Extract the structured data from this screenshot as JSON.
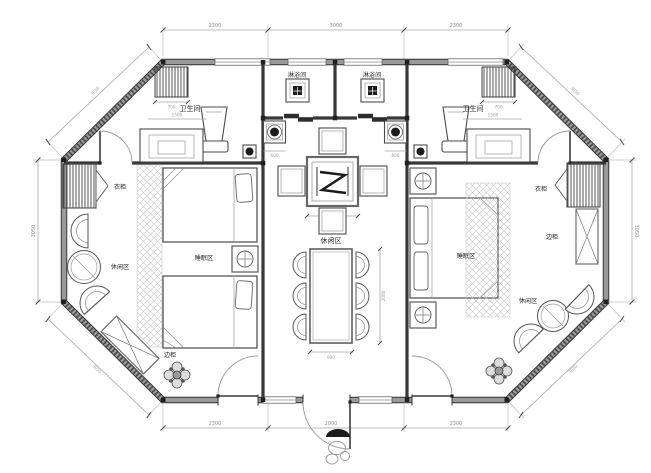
{
  "plan": {
    "type": "octagonal guesthouse floor plan",
    "rooms": {
      "bathroom_left": "卫生间",
      "bathroom_right": "卫生间",
      "shower_left": "淋浴间",
      "shower_right": "淋浴间",
      "lounge_left": "休闲区",
      "lounge_center": "休闲区",
      "lounge_right": "休闲区",
      "sleep_left": "睡眠区",
      "sleep_right": "睡眠区"
    },
    "furniture": {
      "wardrobe_left": "衣柜",
      "wardrobe_right": "衣柜",
      "side_cabinet_left": "边柜",
      "side_cabinet_right": "边柜"
    },
    "dimensions": {
      "top": [
        "2300",
        "3000",
        "2300"
      ],
      "bottom": [
        "2300",
        "2000",
        "2300"
      ],
      "left": "3050",
      "right": "3050",
      "diag_top_left": "3050",
      "diag_top_right": "3050",
      "diag_bottom_left": "3050",
      "diag_bottom_right": "3050",
      "radiator_left": "700",
      "radiator_right": "700",
      "bath_inner_left": "1500",
      "bath_inner_right": "1500",
      "basin_left": "600",
      "basin_right": "600",
      "tea_table": "1000",
      "dining_table_width": "900",
      "dining_table_length": "2000"
    },
    "colors": {
      "background": "#ffffff",
      "wall_core": "#9a9a9a",
      "wall_edge": "#303030",
      "linework": "#4a4a4a",
      "dimension": "#8c8c8c",
      "hatch": "#c4c4c4",
      "fixture_dark": "#1d1d1d"
    }
  }
}
